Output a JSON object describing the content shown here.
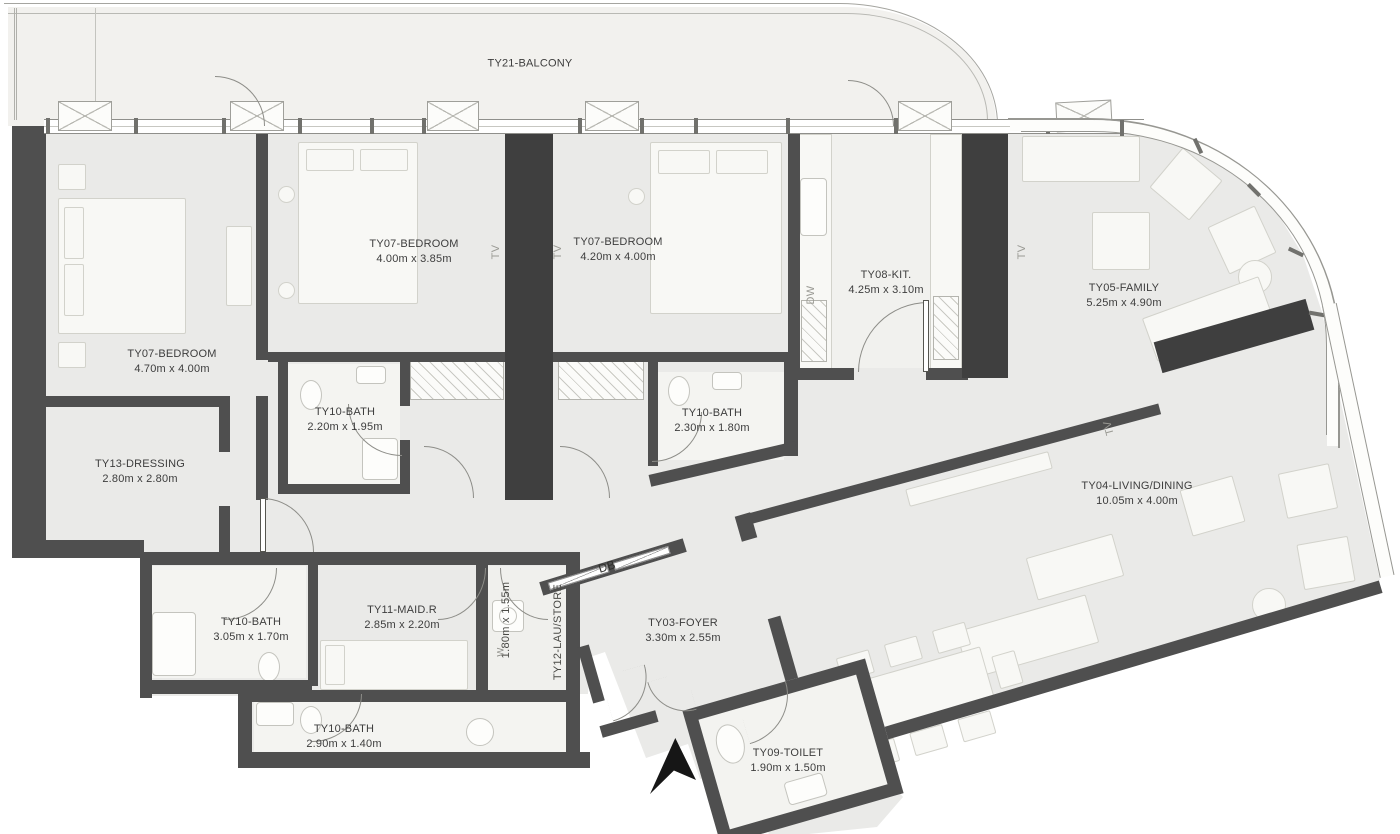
{
  "title": "Apartment floor plan",
  "balcony": {
    "label": "TY21-BALCONY"
  },
  "rooms": [
    {
      "id": "bedroom-master",
      "name": "TY07-BEDROOM",
      "dims": "4.70m x 4.00m"
    },
    {
      "id": "bedroom-2",
      "name": "TY07-BEDROOM",
      "dims": "4.00m x 3.85m"
    },
    {
      "id": "bedroom-3",
      "name": "TY07-BEDROOM",
      "dims": "4.20m x 4.00m"
    },
    {
      "id": "kitchen",
      "name": "TY08-KIT.",
      "dims": "4.25m x 3.10m"
    },
    {
      "id": "family",
      "name": "TY05-FAMILY",
      "dims": "5.25m x 4.90m"
    },
    {
      "id": "bath-1",
      "name": "TY10-BATH",
      "dims": "2.20m x 1.95m"
    },
    {
      "id": "bath-2",
      "name": "TY10-BATH",
      "dims": "2.30m x 1.80m"
    },
    {
      "id": "dressing",
      "name": "TY13-DRESSING",
      "dims": "2.80m x 2.80m"
    },
    {
      "id": "living-dining",
      "name": "TY04-LIVING/DINING",
      "dims": "10.05m x 4.00m"
    },
    {
      "id": "bath-3",
      "name": "TY10-BATH",
      "dims": "3.05m x 1.70m"
    },
    {
      "id": "maid-room",
      "name": "TY11-MAID.R",
      "dims": "2.85m x 2.20m"
    },
    {
      "id": "laundry-store",
      "name": "TY12-LAU/STORE",
      "dims": "1.80m x 1.55m"
    },
    {
      "id": "foyer",
      "name": "TY03-FOYER",
      "dims": "3.30m x 2.55m"
    },
    {
      "id": "bath-4",
      "name": "TY10-BATH",
      "dims": "2.90m x 1.40m"
    },
    {
      "id": "toilet",
      "name": "TY09-TOILET",
      "dims": "1.90m x 1.50m"
    }
  ],
  "annotations": {
    "db": "DB",
    "dw": "DW",
    "washer": "W",
    "tv": "TV"
  },
  "colors": {
    "wall": "#4f4f4f",
    "pillar": "#3f3f3f",
    "floor": "#eaeae8",
    "balcony_floor": "#f2f1ee",
    "bath_floor": "#f4f4f1",
    "text": "#3d3d3d"
  }
}
